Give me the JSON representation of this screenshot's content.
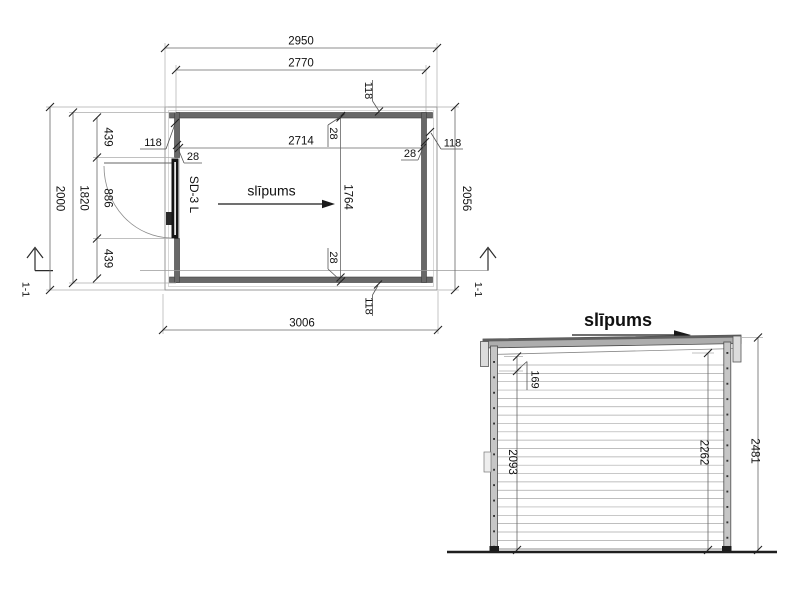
{
  "plan": {
    "slope_label": "slīpums",
    "door_label": "SD-3 L",
    "section_label": "1-1",
    "wall_thickness": "28",
    "overhang": "118",
    "dims": {
      "roof_width": "2950",
      "wall_outer_width": "2770",
      "interior_width": "2714",
      "interior_depth": "1764",
      "overall_depth": "2000",
      "wall_outer_depth": "1820",
      "door_offset_top": "439",
      "door_opening": "886",
      "door_offset_bottom": "439",
      "right_depth": "2056",
      "base_width": "3006"
    }
  },
  "elevation": {
    "title": "slīpums",
    "dims": {
      "roof_drop": "169",
      "wall_height_low": "2093",
      "wall_height_high": "2262",
      "total_height": "2481"
    }
  },
  "colors": {
    "background": "#ffffff",
    "line": "#555555",
    "dimension_line": "#666666",
    "text": "#111111",
    "wall_fill": "#686868",
    "roof_fill": "#adadad"
  }
}
